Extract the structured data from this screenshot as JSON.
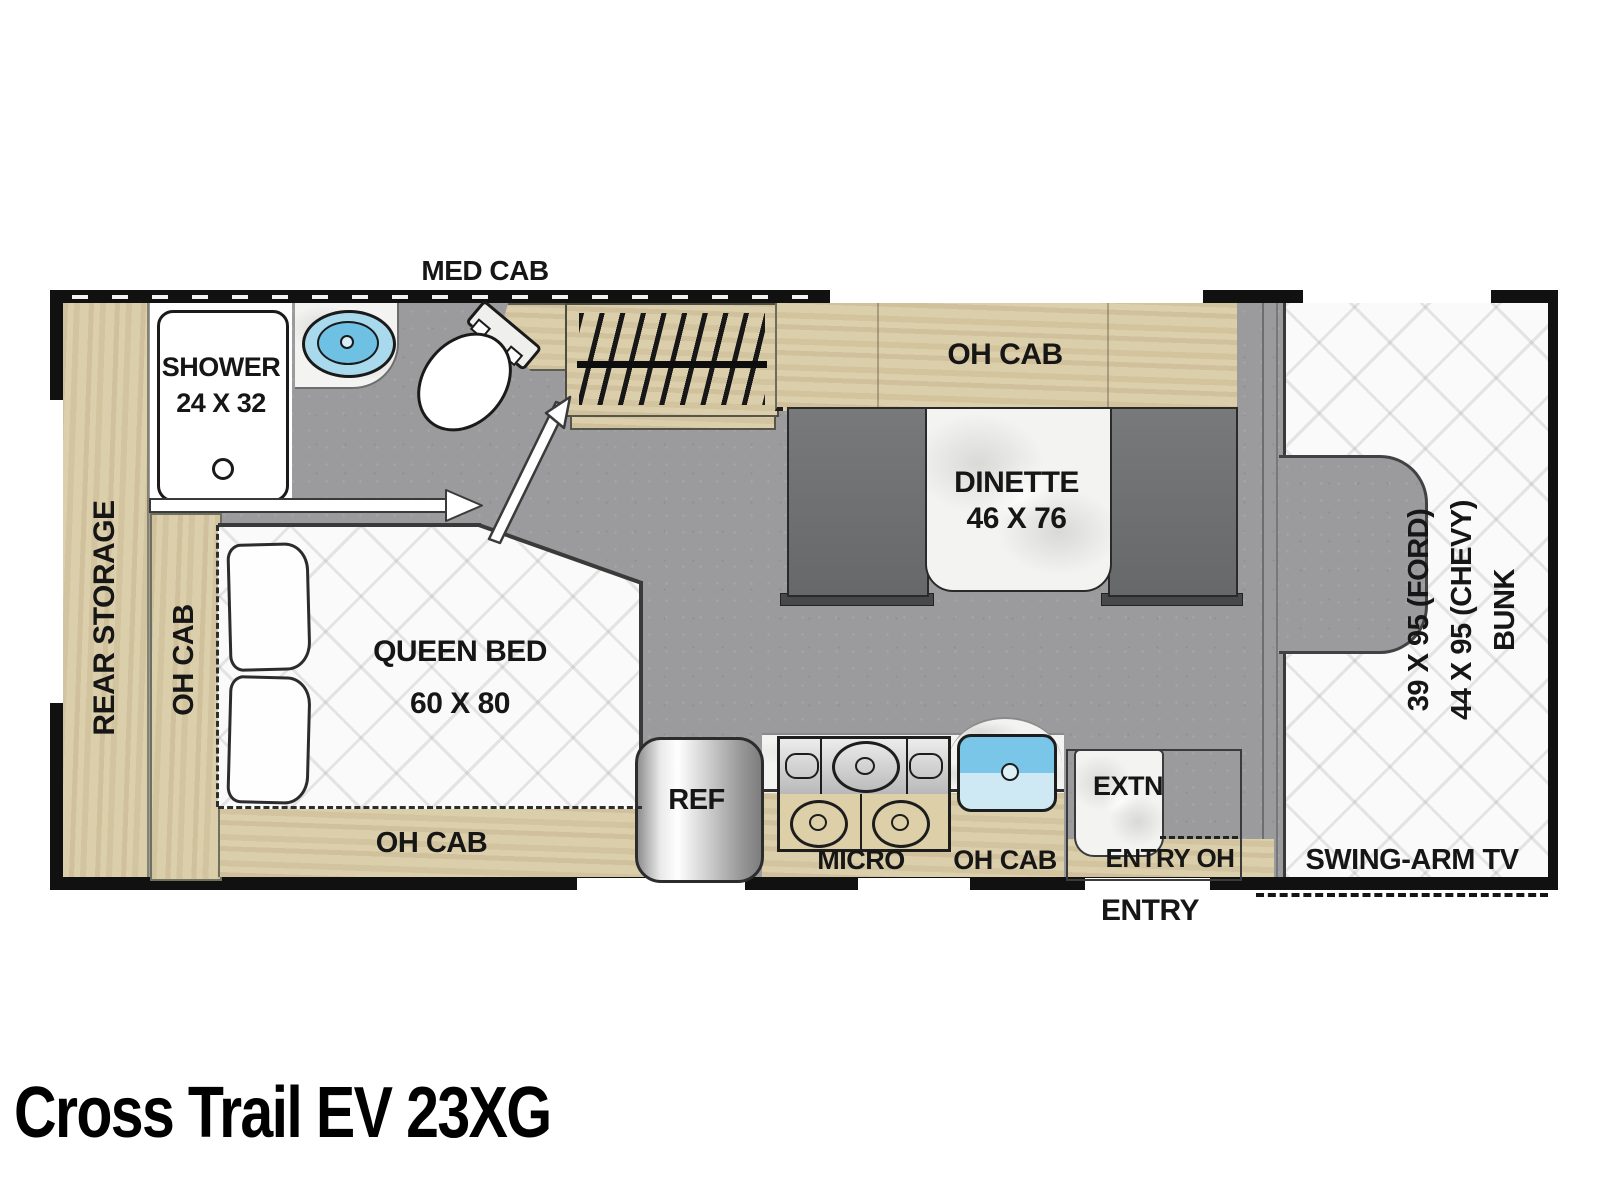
{
  "title": "Cross Trail EV 23XG",
  "labels": {
    "med_cab": "MED CAB",
    "shower": "SHOWER",
    "shower_dims": "24 X 32",
    "rear_storage": "REAR STORAGE",
    "oh_cab": "OH CAB",
    "queen_bed": "QUEEN BED",
    "queen_bed_dims": "60 X 80",
    "dinette": "DINETTE",
    "dinette_dims": "46 X 76",
    "bunk_line1": "39 X 95 (FORD)",
    "bunk_line2": "44 X 95 (CHEVY)",
    "bunk_line3": "BUNK",
    "ref": "REF",
    "micro": "MICRO",
    "extn": "EXTN",
    "entry_oh": "ENTRY OH",
    "entry": "ENTRY",
    "swing_arm_tv": "SWING-ARM TV"
  },
  "colors": {
    "wall": "#111111",
    "floor": "#9b9b9d",
    "wood": "#d9cba6",
    "bench": "#6f7173",
    "marble_white": "#f3f3f1",
    "sink_blue": "#79c6e8",
    "mattress_white": "#fafafa"
  }
}
